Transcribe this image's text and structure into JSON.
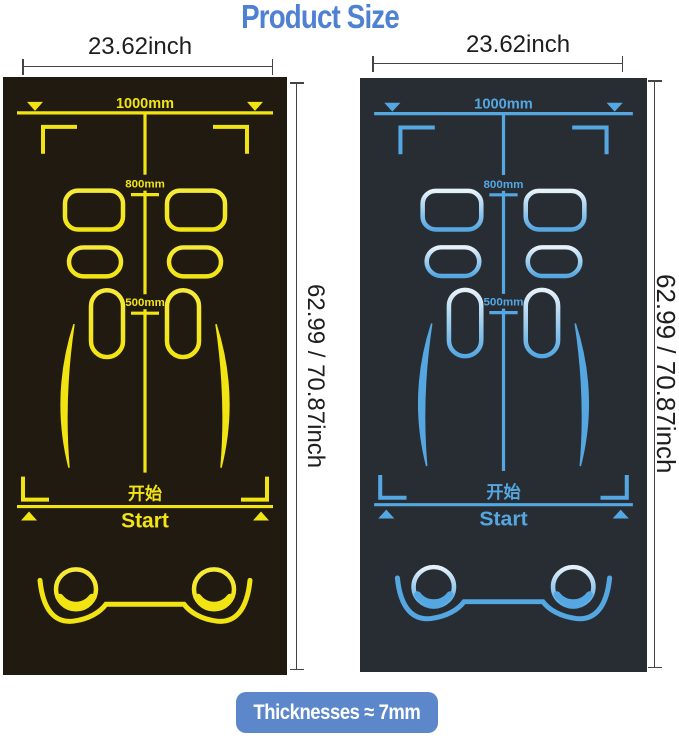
{
  "title": {
    "text": "Product Size",
    "color": "#4f81d3"
  },
  "mats": [
    {
      "name": "yellow-mat",
      "width_label": "23.62inch",
      "height_label": "62.99 / 70.87inch",
      "bg_color": "#201a11",
      "line_color": "#f2e412",
      "highlight_color": "#f6ea3a",
      "markings": {
        "width": "1000mm",
        "upper": "800mm",
        "lower": "500mm",
        "start_cn": "开始",
        "start_en": "Start"
      }
    },
    {
      "name": "blue-mat",
      "width_label": "23.62inch",
      "height_label": "62.99 / 70.87inch",
      "bg_color": "#272d33",
      "line_color": "#55a7e2",
      "highlight_color": "#e6f2fa",
      "markings": {
        "width": "1000mm",
        "upper": "800mm",
        "lower": "500mm",
        "start_cn": "开始",
        "start_en": "Start"
      }
    }
  ],
  "thickness_badge": {
    "text": "Thicknesses ≈ 7mm",
    "bg_color": "#5c88cb",
    "text_color": "#ffffff"
  },
  "dimension_lines": {
    "color": "#444444",
    "label_color": "#1e1e1e"
  }
}
